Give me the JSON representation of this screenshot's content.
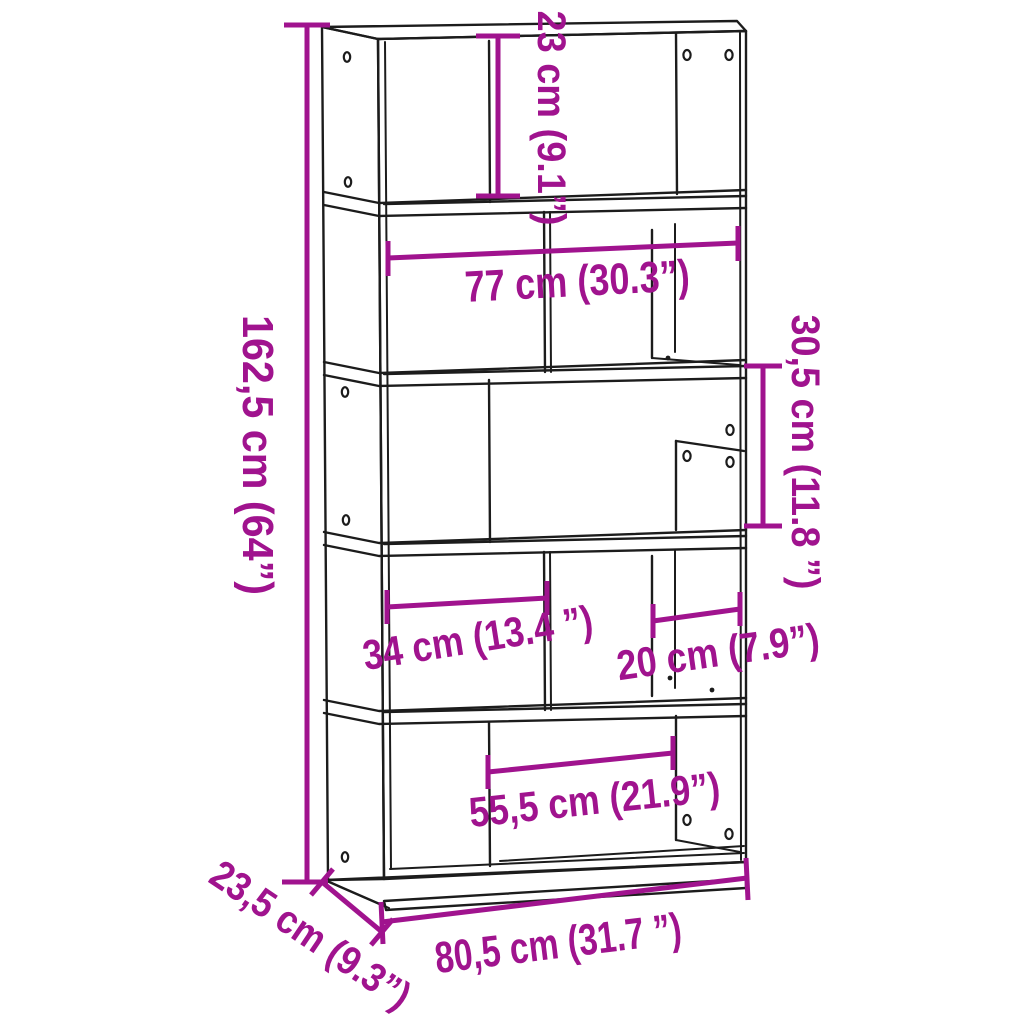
{
  "colors": {
    "dimension_accent": "#A0138E",
    "drawing_line": "#1C1C1C",
    "background": "#FFFFFF"
  },
  "dimensions": {
    "top_tier_inner_height": {
      "label": "23 cm (9.1”)"
    },
    "inner_width": {
      "label": "77 cm (30.3”)"
    },
    "overall_height": {
      "label": "162,5 cm (64”)"
    },
    "tier_height": {
      "label": "30,5 cm (11.8 ”)"
    },
    "left_compartment_width": {
      "label": "34 cm (13.4 ”)"
    },
    "right_compartment_width": {
      "label": "20 cm (7.9”)"
    },
    "bottom_compartment_width": {
      "label": "55,5 cm (21.9”)"
    },
    "overall_width": {
      "label": "80,5 cm (31.7 ”)"
    },
    "depth": {
      "label": "23,5 cm (9.3”)"
    }
  }
}
